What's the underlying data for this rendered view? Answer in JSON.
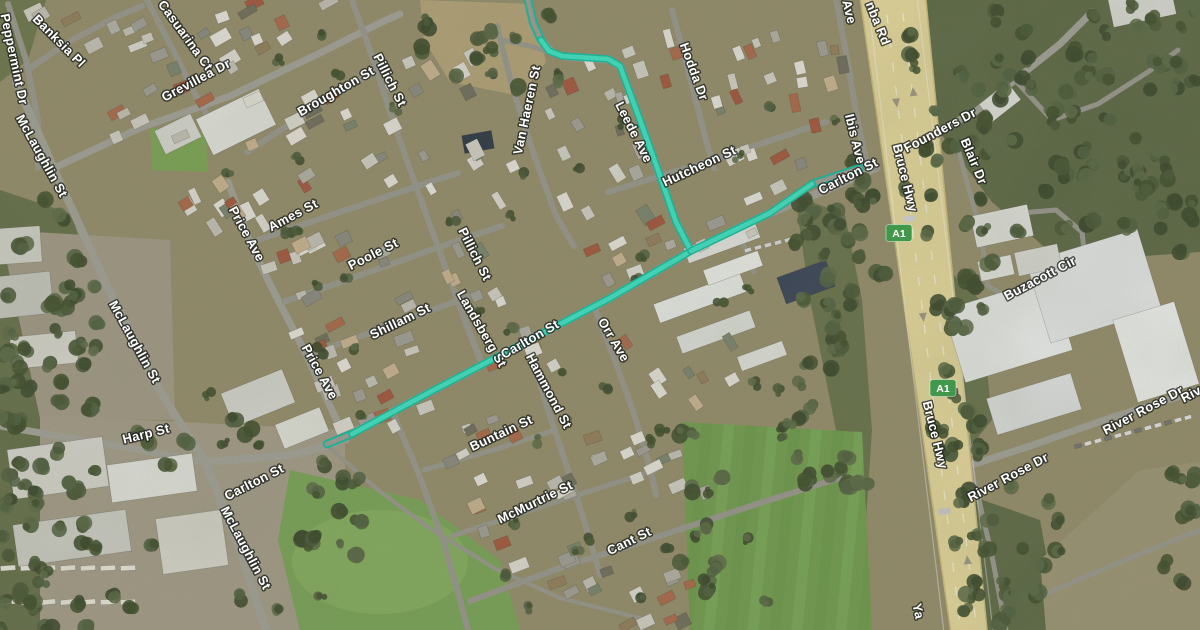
{
  "map": {
    "description": "Satellite map view of a suburb beside the Bruce Hwy (A1) with Leede Ave and Carlton St highlighted as a selected teal route",
    "view_mode": "satellite",
    "colors": {
      "route": "#3ee8c8",
      "route_casing": "#14c0a4",
      "road": "#a6a49b",
      "road_minor": "#9c9a91",
      "highway_fill": "#e9db9f",
      "highway_edge": "#cfc083",
      "label_fill": "#ffffff",
      "label_halo": "#1d201c",
      "shield_green": "#42984a"
    },
    "shields": [
      {
        "label": "A1",
        "x": 899,
        "y": 233
      },
      {
        "label": "A1",
        "x": 943,
        "y": 388
      }
    ],
    "labels": [
      {
        "text": "Peppermint Dr",
        "x": 10,
        "y": 60,
        "r": 78
      },
      {
        "text": "Banksia Pl",
        "x": 56,
        "y": 44,
        "r": 45
      },
      {
        "text": "Casuarina Ct",
        "x": 182,
        "y": 38,
        "r": 54
      },
      {
        "text": "Grevillea Dr",
        "x": 198,
        "y": 84,
        "r": -28
      },
      {
        "text": "McLaughlin St",
        "x": 38,
        "y": 158,
        "r": 61
      },
      {
        "text": "McLaughlin St",
        "x": 131,
        "y": 344,
        "r": 61
      },
      {
        "text": "McLaughlin St",
        "x": 242,
        "y": 550,
        "r": 62
      },
      {
        "text": "Harp St",
        "x": 147,
        "y": 438,
        "r": -14
      },
      {
        "text": "Carlton St",
        "x": 256,
        "y": 486,
        "r": -27
      },
      {
        "text": "Price Ave",
        "x": 243,
        "y": 236,
        "r": 61
      },
      {
        "text": "Price Ave",
        "x": 316,
        "y": 374,
        "r": 61
      },
      {
        "text": "Ames St",
        "x": 295,
        "y": 219,
        "r": -28
      },
      {
        "text": "Poole St",
        "x": 375,
        "y": 258,
        "r": -27
      },
      {
        "text": "Shillam St",
        "x": 402,
        "y": 325,
        "r": -26
      },
      {
        "text": "Broughton St",
        "x": 338,
        "y": 95,
        "r": -30
      },
      {
        "text": "Pillich St",
        "x": 386,
        "y": 82,
        "r": 63
      },
      {
        "text": "Pillich St",
        "x": 471,
        "y": 256,
        "r": 63
      },
      {
        "text": "Landsberg St",
        "x": 478,
        "y": 331,
        "r": 60
      },
      {
        "text": "Van Haeren St",
        "x": 531,
        "y": 111,
        "r": -78
      },
      {
        "text": "Leede Ave",
        "x": 630,
        "y": 134,
        "r": 63
      },
      {
        "text": "Hodda Dr",
        "x": 690,
        "y": 73,
        "r": 70
      },
      {
        "text": "Hutcheon St",
        "x": 701,
        "y": 170,
        "r": -25
      },
      {
        "text": "Carlton St",
        "x": 532,
        "y": 343,
        "r": -30
      },
      {
        "text": "Orr Ave",
        "x": 610,
        "y": 342,
        "r": 59
      },
      {
        "text": "Hammond St",
        "x": 545,
        "y": 393,
        "r": 62
      },
      {
        "text": "Buntain St",
        "x": 503,
        "y": 437,
        "r": -25
      },
      {
        "text": "McMurtrie St",
        "x": 537,
        "y": 506,
        "r": -26
      },
      {
        "text": "Cant St",
        "x": 631,
        "y": 545,
        "r": -26
      },
      {
        "text": "Ibis Ave",
        "x": 851,
        "y": 140,
        "r": 76
      },
      {
        "text": "Ave",
        "x": 845,
        "y": 13,
        "r": 76,
        "partial": true
      },
      {
        "text": "nba Rd",
        "x": 874,
        "y": 25,
        "r": 68,
        "partial": true
      },
      {
        "text": "Carlton St",
        "x": 850,
        "y": 180,
        "r": -27
      },
      {
        "text": "Bruce Hwy",
        "x": 901,
        "y": 179,
        "r": 76
      },
      {
        "text": "Bruce Hwy",
        "x": 931,
        "y": 436,
        "r": 76
      },
      {
        "text": "Founders Dr",
        "x": 942,
        "y": 134,
        "r": -28
      },
      {
        "text": "Blair Dr",
        "x": 970,
        "y": 163,
        "r": 67
      },
      {
        "text": "Buzacott Cir",
        "x": 1042,
        "y": 282,
        "r": -28
      },
      {
        "text": "River Rose Dr",
        "x": 1010,
        "y": 481,
        "r": -28
      },
      {
        "text": "River Rose Dr",
        "x": 1145,
        "y": 414,
        "r": -28
      },
      {
        "text": "Riv",
        "x": 1193,
        "y": 398,
        "r": -28,
        "partial": true
      },
      {
        "text": "Ya",
        "x": 914,
        "y": 612,
        "r": 78,
        "partial": true
      }
    ],
    "route": {
      "highlighted_streets": [
        "Leede Ave",
        "Carlton St"
      ],
      "solid": [
        [
          [
            541,
            40
          ],
          [
            549,
            51
          ],
          [
            562,
            56
          ],
          [
            608,
            59
          ],
          [
            620,
            66
          ],
          [
            640,
            120
          ],
          [
            658,
            170
          ],
          [
            676,
            222
          ],
          [
            691,
            251
          ],
          [
            610,
            298
          ],
          [
            520,
            345
          ],
          [
            430,
            392
          ],
          [
            352,
            434
          ]
        ],
        [
          [
            691,
            251
          ],
          [
            770,
            213
          ],
          [
            812,
            184
          ]
        ]
      ],
      "hollow": [
        [
          [
            527,
            -4
          ],
          [
            533,
            22
          ],
          [
            541,
            40
          ]
        ],
        [
          [
            352,
            434
          ],
          [
            327,
            444
          ]
        ],
        [
          [
            812,
            184
          ],
          [
            860,
            168
          ]
        ]
      ]
    },
    "highway": {
      "name": "Bruce Hwy",
      "polygon": [
        [
          859,
          -10
        ],
        [
          925,
          -10
        ],
        [
          988,
          640
        ],
        [
          952,
          640
        ]
      ],
      "centerline": [
        [
          892,
          -10
        ],
        [
          970,
          640
        ]
      ]
    },
    "roads": [
      {
        "name": "Peppermint Dr",
        "w": 6,
        "pts": [
          [
            8,
            4
          ],
          [
            26,
            60
          ],
          [
            38,
            120
          ],
          [
            38,
            168
          ]
        ]
      },
      {
        "name": "Banksia Pl",
        "w": 6,
        "pts": [
          [
            30,
            68
          ],
          [
            72,
            40
          ],
          [
            118,
            16
          ],
          [
            142,
            6
          ]
        ]
      },
      {
        "name": "Casuarina Ct",
        "w": 6,
        "pts": [
          [
            147,
            0
          ],
          [
            172,
            48
          ],
          [
            196,
            96
          ],
          [
            212,
            124
          ]
        ]
      },
      {
        "name": "Grevillea Dr",
        "w": 7,
        "pts": [
          [
            54,
            168
          ],
          [
            140,
            128
          ],
          [
            230,
            96
          ],
          [
            318,
            54
          ],
          [
            382,
            22
          ],
          [
            400,
            14
          ]
        ]
      },
      {
        "name": "McLaughlin St",
        "w": 8,
        "pts": [
          [
            16,
            82
          ],
          [
            58,
            178
          ],
          [
            108,
            288
          ],
          [
            158,
            388
          ],
          [
            205,
            462
          ],
          [
            238,
            545
          ],
          [
            266,
            630
          ]
        ]
      },
      {
        "name": "Harp St",
        "w": 7,
        "pts": [
          [
            0,
            426
          ],
          [
            70,
            438
          ],
          [
            140,
            450
          ],
          [
            205,
            462
          ]
        ]
      },
      {
        "name": "Carlton St",
        "w": 8,
        "pts": [
          [
            205,
            462
          ],
          [
            292,
            455
          ],
          [
            330,
            445
          ],
          [
            430,
            392
          ],
          [
            520,
            345
          ],
          [
            610,
            298
          ],
          [
            691,
            251
          ],
          [
            770,
            213
          ],
          [
            840,
            184
          ],
          [
            876,
            168
          ]
        ]
      },
      {
        "name": "Price Ave",
        "w": 7,
        "pts": [
          [
            228,
            182
          ],
          [
            252,
            248
          ],
          [
            278,
            300
          ],
          [
            306,
            354
          ],
          [
            330,
            406
          ],
          [
            346,
            440
          ]
        ]
      },
      {
        "name": "Ames St",
        "w": 6,
        "pts": [
          [
            252,
            242
          ],
          [
            340,
            212
          ],
          [
            430,
            182
          ],
          [
            458,
            173
          ]
        ]
      },
      {
        "name": "Poole St",
        "w": 6,
        "pts": [
          [
            284,
            302
          ],
          [
            380,
            268
          ],
          [
            468,
            237
          ],
          [
            502,
            226
          ]
        ]
      },
      {
        "name": "Shillam St",
        "w": 6,
        "pts": [
          [
            306,
            356
          ],
          [
            400,
            322
          ],
          [
            478,
            293
          ]
        ]
      },
      {
        "name": "Broughton St",
        "w": 6,
        "pts": [
          [
            247,
            152
          ],
          [
            330,
            98
          ],
          [
            386,
            64
          ]
        ]
      },
      {
        "name": "Pillich St",
        "w": 6,
        "pts": [
          [
            352,
            0
          ],
          [
            372,
            56
          ],
          [
            394,
            124
          ],
          [
            418,
            192
          ],
          [
            442,
            258
          ],
          [
            462,
            312
          ],
          [
            480,
            358
          ]
        ]
      },
      {
        "name": "Landsberg St",
        "w": 5,
        "pts": [
          [
            450,
            278
          ],
          [
            466,
            326
          ],
          [
            482,
            366
          ]
        ]
      },
      {
        "name": "Van Haeren St",
        "w": 6,
        "pts": [
          [
            497,
            26
          ],
          [
            512,
            86
          ],
          [
            533,
            152
          ],
          [
            556,
            216
          ],
          [
            574,
            246
          ]
        ]
      },
      {
        "name": "Leede Ave",
        "w": 7,
        "pts": [
          [
            528,
            0
          ],
          [
            534,
            24
          ],
          [
            543,
            42
          ],
          [
            552,
            52
          ],
          [
            566,
            57
          ],
          [
            610,
            60
          ],
          [
            621,
            68
          ],
          [
            641,
            122
          ],
          [
            659,
            172
          ],
          [
            677,
            224
          ],
          [
            691,
            251
          ]
        ]
      },
      {
        "name": "Leede Ave west",
        "w": 5,
        "pts": [
          [
            566,
            57
          ],
          [
            530,
            46
          ],
          [
            502,
            40
          ]
        ]
      },
      {
        "name": "Hodda Dr",
        "w": 6,
        "pts": [
          [
            672,
            10
          ],
          [
            690,
            78
          ],
          [
            706,
            140
          ],
          [
            714,
            168
          ]
        ]
      },
      {
        "name": "Hutcheon St",
        "w": 6,
        "pts": [
          [
            608,
            192
          ],
          [
            700,
            164
          ],
          [
            790,
            134
          ],
          [
            826,
            122
          ]
        ]
      },
      {
        "name": "Ibis Ave",
        "w": 6,
        "pts": [
          [
            836,
            0
          ],
          [
            847,
            58
          ],
          [
            857,
            118
          ],
          [
            866,
            160
          ],
          [
            876,
            168
          ]
        ]
      },
      {
        "name": "Orr Ave",
        "w": 6,
        "pts": [
          [
            594,
            306
          ],
          [
            614,
            358
          ],
          [
            634,
            414
          ],
          [
            650,
            468
          ],
          [
            656,
            495
          ]
        ]
      },
      {
        "name": "Hammond St",
        "w": 6,
        "pts": [
          [
            528,
            344
          ],
          [
            548,
            410
          ],
          [
            570,
            476
          ],
          [
            590,
            540
          ],
          [
            600,
            575
          ]
        ]
      },
      {
        "name": "Buntain St",
        "w": 5,
        "pts": [
          [
            424,
            470
          ],
          [
            500,
            448
          ],
          [
            552,
            431
          ]
        ]
      },
      {
        "name": "west lane",
        "w": 6,
        "pts": [
          [
            393,
            413
          ],
          [
            418,
            472
          ],
          [
            443,
            540
          ],
          [
            460,
            600
          ],
          [
            468,
            630
          ]
        ]
      },
      {
        "name": "McMurtrie St",
        "w": 5,
        "pts": [
          [
            452,
            536
          ],
          [
            540,
            507
          ],
          [
            628,
            479
          ],
          [
            656,
            470
          ]
        ]
      },
      {
        "name": "Cant St",
        "w": 6,
        "pts": [
          [
            470,
            601
          ],
          [
            560,
            568
          ],
          [
            660,
            536
          ],
          [
            760,
            503
          ],
          [
            846,
            476
          ]
        ]
      },
      {
        "name": "Founders Dr",
        "w": 7,
        "pts": [
          [
            930,
            135
          ],
          [
            975,
            112
          ],
          [
            1015,
            80
          ],
          [
            1060,
            44
          ],
          [
            1092,
            12
          ]
        ]
      },
      {
        "name": "Founders branch",
        "w": 5,
        "pts": [
          [
            1015,
            80
          ],
          [
            1052,
            120
          ],
          [
            1098,
            104
          ],
          [
            1148,
            72
          ],
          [
            1178,
            50
          ]
        ]
      },
      {
        "name": "Blair Dr",
        "w": 5,
        "pts": [
          [
            956,
            141
          ],
          [
            968,
            186
          ],
          [
            980,
            228
          ]
        ]
      },
      {
        "name": "Buzacott Cir",
        "w": 5,
        "pts": [
          [
            980,
            228
          ],
          [
            1008,
            214
          ],
          [
            1056,
            210
          ],
          [
            1082,
            232
          ],
          [
            1086,
            268
          ],
          [
            1062,
            294
          ],
          [
            1016,
            302
          ],
          [
            988,
            286
          ],
          [
            980,
            228
          ]
        ]
      },
      {
        "name": "River Rose Dr",
        "w": 7,
        "pts": [
          [
            950,
            472
          ],
          [
            1030,
            446
          ],
          [
            1110,
            418
          ],
          [
            1200,
            390
          ]
        ]
      },
      {
        "name": "service rd",
        "w": 5,
        "pts": [
          [
            972,
            470
          ],
          [
            992,
            556
          ],
          [
            1006,
            630
          ]
        ]
      },
      {
        "name": "park access",
        "w": 5,
        "pts": [
          [
            1036,
            598
          ],
          [
            1120,
            562
          ],
          [
            1200,
            530
          ]
        ]
      },
      {
        "name": "school access",
        "w": 5,
        "pts": [
          [
            738,
            230
          ],
          [
            754,
            272
          ]
        ]
      },
      {
        "name": "park path",
        "w": 4,
        "pts": [
          [
            330,
            448
          ],
          [
            378,
            490
          ],
          [
            432,
            530
          ],
          [
            494,
            568
          ],
          [
            560,
            598
          ],
          [
            640,
            618
          ]
        ]
      }
    ]
  }
}
